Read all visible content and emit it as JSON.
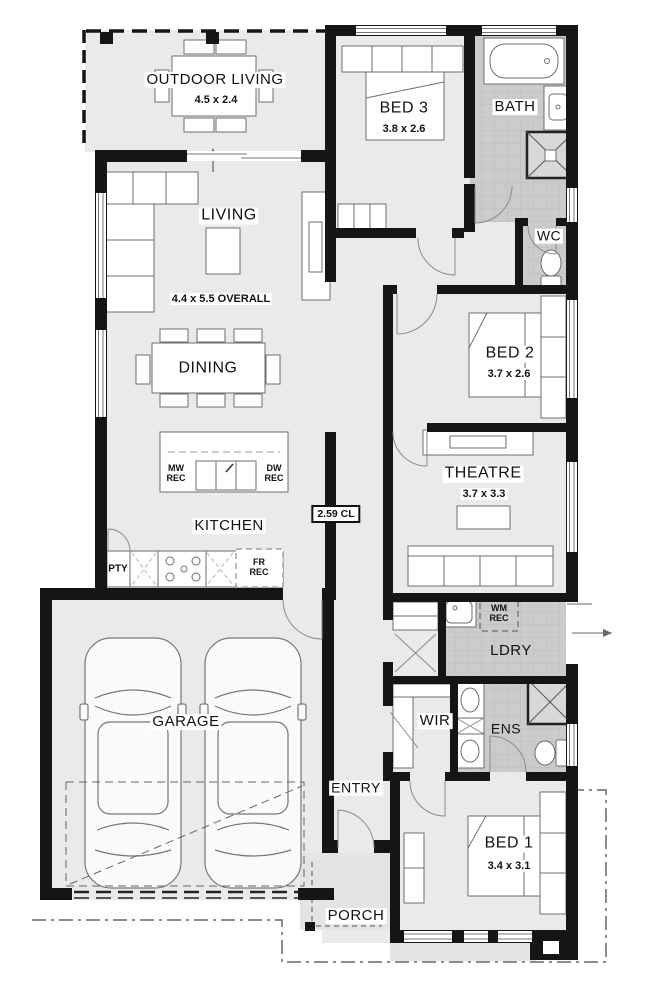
{
  "rooms": {
    "outdoor_living": {
      "name": "OUTDOOR LIVING",
      "dims": "4.5 x 2.4"
    },
    "living": {
      "name": "LIVING",
      "dims": "4.4 x 5.5 OVERALL"
    },
    "dining": {
      "name": "DINING"
    },
    "kitchen": {
      "name": "KITCHEN"
    },
    "bed3": {
      "name": "BED 3",
      "dims": "3.8 x 2.6"
    },
    "bath": {
      "name": "BATH"
    },
    "wc": {
      "name": "WC"
    },
    "bed2": {
      "name": "BED 2",
      "dims": "3.7 x 2.6"
    },
    "theatre": {
      "name": "THEATRE",
      "dims": "3.7 x 3.3"
    },
    "laundry": {
      "name": "LDRY"
    },
    "wir": {
      "name": "WIR"
    },
    "ens": {
      "name": "ENS"
    },
    "garage": {
      "name": "GARAGE"
    },
    "entry": {
      "name": "ENTRY"
    },
    "bed1": {
      "name": "BED 1",
      "dims": "3.4 x 3.1"
    },
    "porch": {
      "name": "PORCH"
    }
  },
  "annotations": {
    "ceiling_height": "2.59 CL",
    "pantry": "PTY",
    "microwave_recess": "MW\nREC",
    "dishwasher_recess": "DW\nREC",
    "fridge_recess": "FR\nREC",
    "washing_machine_recess": "WM\nREC"
  },
  "colors": {
    "wall": "#151515",
    "floor": "#eaeaea",
    "tile": "#cbcbcb"
  }
}
